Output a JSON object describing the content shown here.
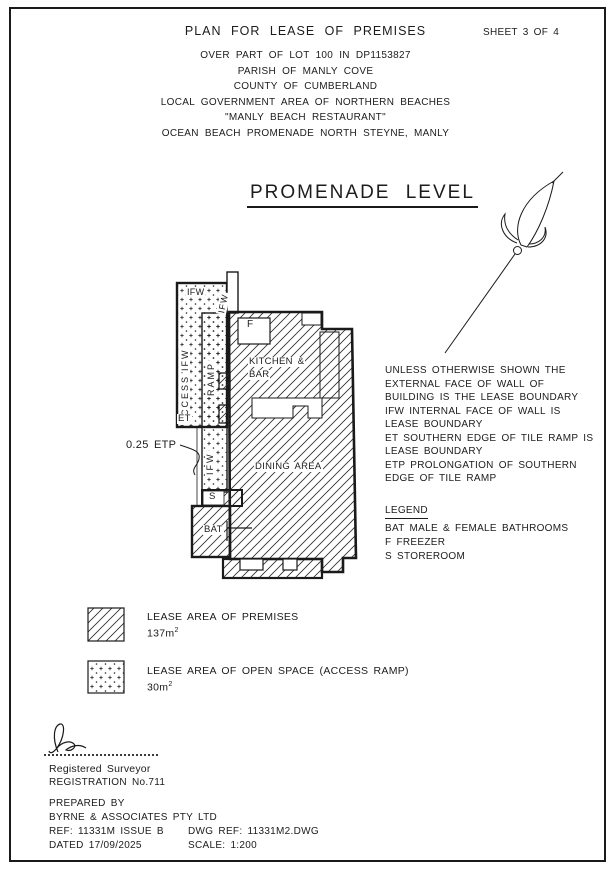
{
  "header": {
    "title": "PLAN FOR LEASE OF PREMISES",
    "sheet": "SHEET 3 OF 4",
    "lines": [
      "OVER PART OF LOT 100 IN DP1153827",
      "PARISH OF MANLY COVE",
      "COUNTY OF CUMBERLAND",
      "LOCAL GOVERNMENT AREA OF NORTHERN BEACHES",
      "\"MANLY BEACH RESTAURANT\"",
      "OCEAN BEACH PROMENADE NORTH STEYNE, MANLY"
    ]
  },
  "plan": {
    "level_title": "PROMENADE LEVEL",
    "labels": {
      "ifw": "IFW",
      "access": "ACCESS",
      "ramp": "RAMP",
      "et": "ET",
      "etp": "0.25 ETP",
      "freezer": "F",
      "kitchen_line1": "KITCHEN &",
      "kitchen_line2": "BAR",
      "dining": "DINING AREA",
      "store": "S",
      "bathrooms": "BAT"
    }
  },
  "notes": {
    "lines": [
      "UNLESS OTHERWISE SHOWN THE",
      "EXTERNAL FACE OF WALL OF",
      "BUILDING IS THE LEASE BOUNDARY",
      "IFW INTERNAL FACE OF WALL IS",
      "LEASE BOUNDARY",
      "ET SOUTHERN EDGE OF TILE RAMP IS",
      "LEASE BOUNDARY",
      "ETP PROLONGATION OF SOUTHERN",
      "EDGE OF TILE RAMP"
    ]
  },
  "legend": {
    "title": "LEGEND",
    "entries": [
      "BAT MALE & FEMALE BATHROOMS",
      "F FREEZER",
      "S STOREROOM"
    ]
  },
  "area_legend": {
    "premises": {
      "label": "LEASE AREA OF PREMISES",
      "area": "137m",
      "sup": "2"
    },
    "open_space": {
      "label": "LEASE AREA OF OPEN SPACE (ACCESS RAMP)",
      "area": "30m",
      "sup": "2"
    }
  },
  "title_block": {
    "surveyor_caption": "Registered Surveyor",
    "registration": "REGISTRATION No.711",
    "prepared_by": "PREPARED BY",
    "company": "BYRNE & ASSOCIATES PTY LTD",
    "ref": "REF: 11331M ISSUE B",
    "dwg_ref": "DWG REF: 11331M2.DWG",
    "dated": "DATED 17/09/2025",
    "scale": "SCALE: 1:200"
  },
  "colors": {
    "ink": "#1c1c1c",
    "paper": "#ffffff"
  }
}
